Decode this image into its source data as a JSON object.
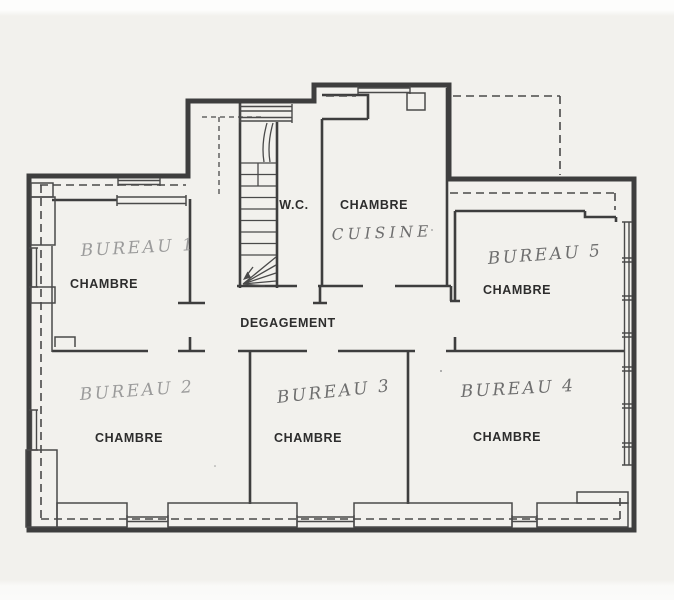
{
  "document": {
    "type": "scanned-floor-plan-sketch",
    "language": "fr",
    "floor_elements": [
      "staircase",
      "radiators",
      "windows",
      "heating-pipes-dashed"
    ]
  },
  "labels": {
    "wc": "W.C.",
    "corridor": "DEGAGEMENT"
  },
  "rooms": [
    {
      "id": "bureau-1",
      "handwritten": "BUREAU 1",
      "printed": "CHAMBRE"
    },
    {
      "id": "cuisine",
      "handwritten": "CUISINE",
      "printed": "CHAMBRE"
    },
    {
      "id": "bureau-5",
      "handwritten": "BUREAU 5",
      "printed": "CHAMBRE"
    },
    {
      "id": "bureau-2",
      "handwritten": "BUREAU 2",
      "printed": "CHAMBRE"
    },
    {
      "id": "bureau-3",
      "handwritten": "BUREAU 3",
      "printed": "CHAMBRE"
    },
    {
      "id": "bureau-4",
      "handwritten": "BUREAU 4",
      "printed": "CHAMBRE"
    }
  ],
  "colors": {
    "paper": "#f2f1ed",
    "wall_ink": "#3e3e3e",
    "thin_ink": "#4a4a4a",
    "printed_text": "#2d2d2d",
    "pencil_light": "#9b9b9b",
    "pencil_dark": "#6e6e6e"
  }
}
